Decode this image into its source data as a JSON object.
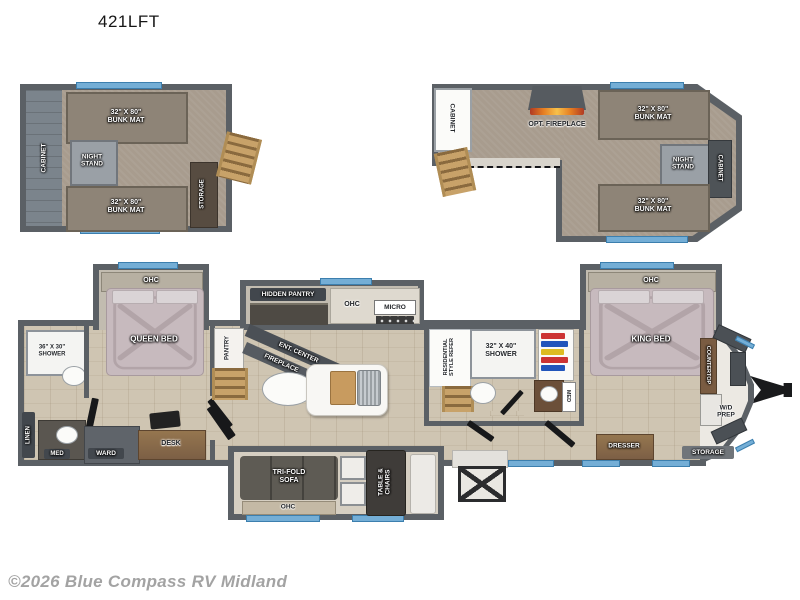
{
  "title": "421LFT",
  "copyright": "©2026 Blue Compass RV Midland",
  "colors": {
    "wall": "#5b6065",
    "floor_wood": "#cfc5b2",
    "loft_carpet": "#a89c8e",
    "bed": "#c7babe",
    "bunk_mat": "#8e8477",
    "window_blue": "#74aed6",
    "ladder_wood": "#c8a269",
    "flame_orange": "#e67e22",
    "badge_gray": "#42474d"
  },
  "loft_left": {
    "cabinet": "CABINET",
    "bunk_top": "32\" X 80\" BUNK MAT",
    "night_stand": "NIGHT STAND",
    "bunk_bottom": "32\" X 80\" BUNK MAT",
    "storage": "STORAGE"
  },
  "loft_right": {
    "cabinet_left": "CABINET",
    "opt_fireplace": "OPT. FIREPLACE",
    "bunk_top": "32\" X 80\" BUNK MAT",
    "night_stand": "NIGHT STAND",
    "cabinet_right": "CABINET",
    "bunk_bottom": "32\" X 80\" BUNK MAT"
  },
  "rear_bath": {
    "shower": "36\" X 30\" SHOWER",
    "linen": "LINEN",
    "med": "MED"
  },
  "bedroom": {
    "ohc": "OHC",
    "queen_bed": "QUEEN BED",
    "ward": "WARD",
    "desk": "DESK",
    "pantry": "PANTRY"
  },
  "kitchen": {
    "hidden_pantry": "HIDDEN PANTRY",
    "ohc": "OHC",
    "micro": "MICRO",
    "ent_center": "ENT. CENTER",
    "fireplace": "FIREPLACE"
  },
  "living": {
    "trifold_sofa": "TRI-FOLD SOFA",
    "ohc": "OHC",
    "table_chairs": "TABLE & CHAIRS"
  },
  "mid_bath": {
    "refer": "RESIDENTIAL STYLE REFER",
    "shower": "32\" X 40\" SHOWER",
    "med": "MED"
  },
  "master": {
    "ohc": "OHC",
    "king_bed": "KING BED",
    "dresser": "DRESSER"
  },
  "front": {
    "countertop": "COUNTERTOP",
    "wd_prep": "W/D PREP",
    "storage": "STORAGE"
  }
}
